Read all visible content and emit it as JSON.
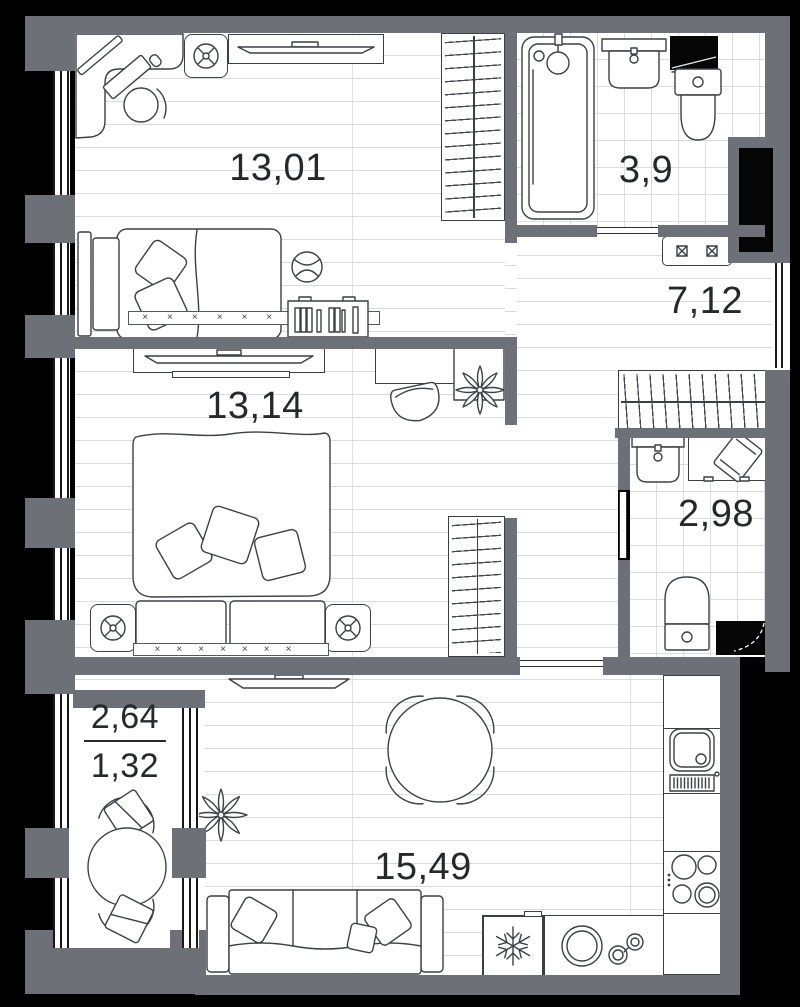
{
  "plan": {
    "type": "apartment-floor-plan",
    "colors": {
      "page": "#000000",
      "wall": "#6d7076",
      "outline": "#3c3f44",
      "floor_line": "#dadbdd",
      "text": "#26282b"
    },
    "rooms": [
      {
        "name": "bedroom-top",
        "area": "13,01"
      },
      {
        "name": "bathroom-top",
        "area": "3,9"
      },
      {
        "name": "hallway",
        "area": "7,12"
      },
      {
        "name": "bedroom-middle",
        "area": "13,14"
      },
      {
        "name": "bathroom-small",
        "area": "2,98"
      },
      {
        "name": "kitchen-living",
        "area": "15,49"
      },
      {
        "name": "balcony",
        "area_full": "2,64",
        "area_coeff": "1,32"
      }
    ],
    "symbols": {
      "radiator_long": "×××××××××",
      "radiator_short": "×××××××"
    }
  }
}
